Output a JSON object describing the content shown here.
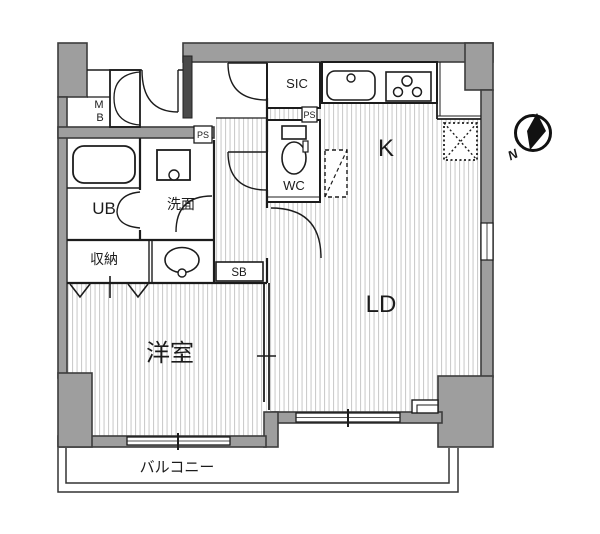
{
  "floor_plan": {
    "title": "apartment-floor-plan",
    "labels": {
      "kitchen": "K",
      "living_dining": "LD",
      "western_room": "洋室",
      "unit_bath": "UB",
      "washroom": "洗面",
      "storage": "収納",
      "toilet": "WC",
      "shoe_in_closet": "SIC",
      "service_box": "SB",
      "meter_box_line1": "M",
      "meter_box_line2": "B",
      "pipe_space_1": "PS",
      "pipe_space_2": "PS",
      "balcony": "バルコニー",
      "north": "N"
    },
    "colors": {
      "wall_fill": "#9e9e9e",
      "wall_outline": "#3c3c3c",
      "line": "#1c1c1c",
      "floor_stripe": "#cccccc",
      "background": "#ffffff"
    }
  }
}
